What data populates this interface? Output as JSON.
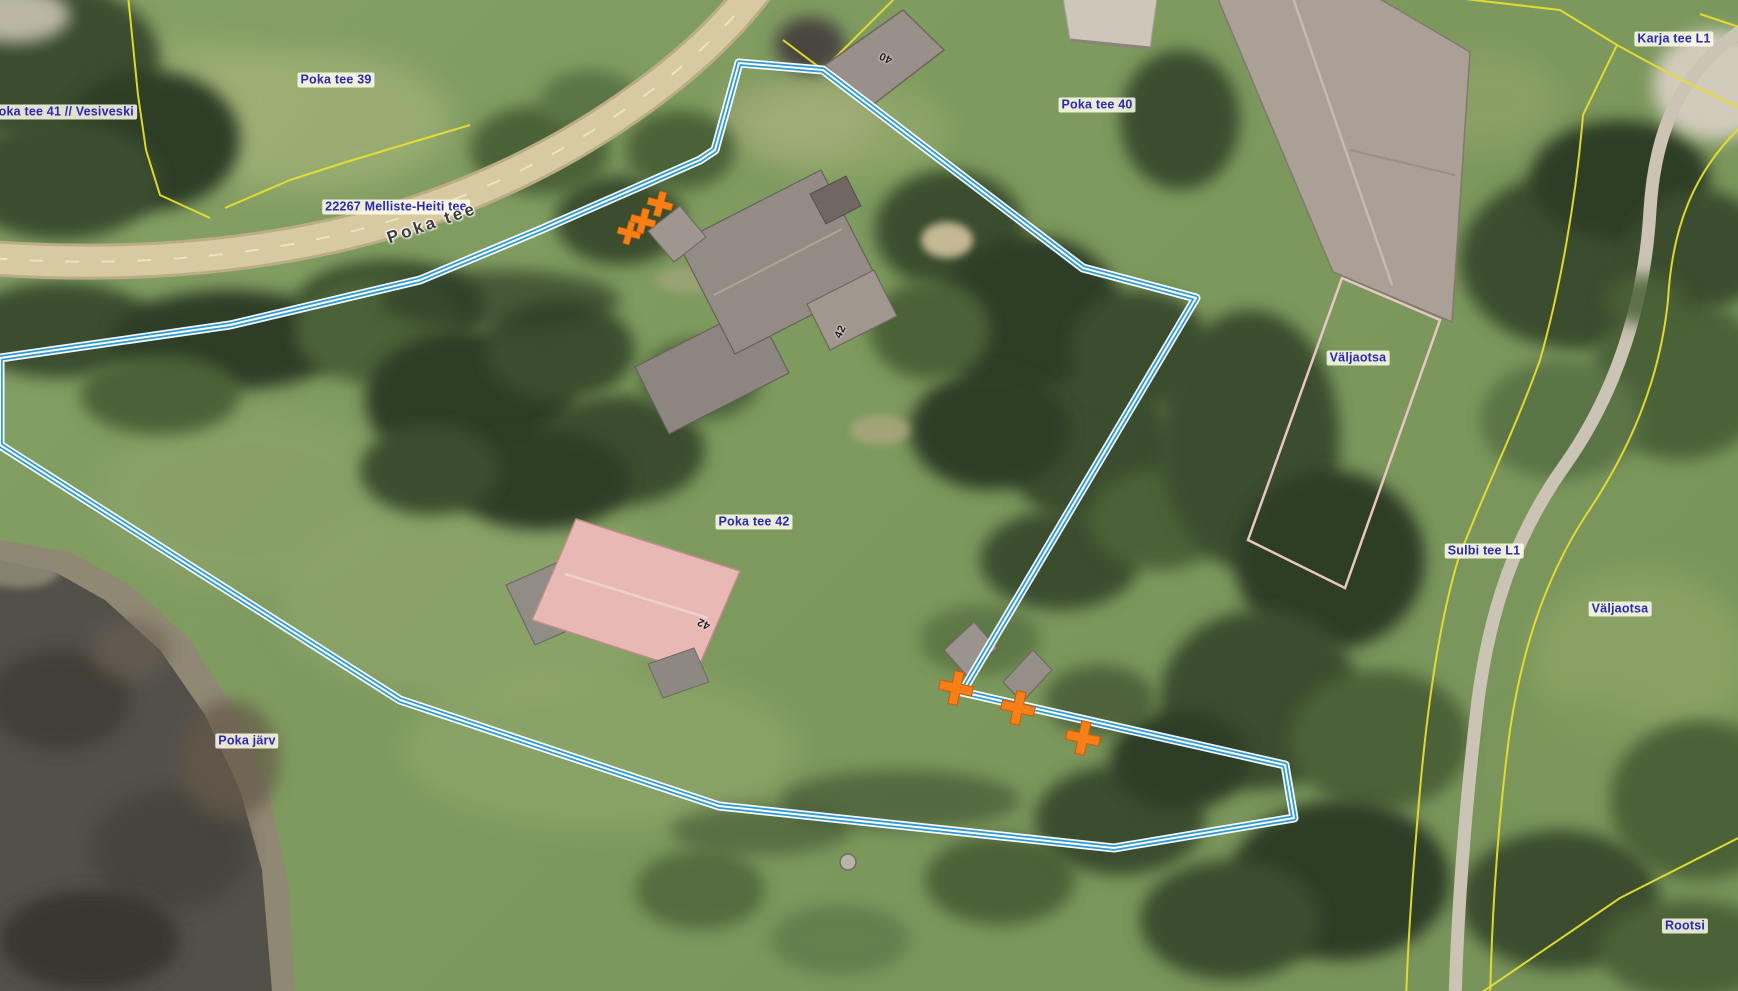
{
  "map": {
    "view": "aerial-cadastral-map",
    "labels": {
      "poka_tee_41": "Poka tee 41 // Vesiveski",
      "poka_tee_39": "Poka tee 39",
      "road_ref": "22267 Melliste-Heiti tee",
      "road_name": "Poka tee",
      "poka_tee_40": "Poka tee 40",
      "karja_tee_l1": "Karja tee L1",
      "valjaotsa_north": "Väljaotsa",
      "sulbi_tee_l1": "Sulbi tee L1",
      "valjaotsa_east": "Väljaotsa",
      "poka_tee_42": "Poka tee 42",
      "poka_jarv": "Poka järv",
      "rootsi": "Rootsi"
    },
    "building_numbers": {
      "b40": "40",
      "b42_main": "42",
      "b42_south": "42"
    },
    "colors": {
      "selected_parcel_outline": "#2d9ad6",
      "cadastral_boundary": "#e6df2e",
      "land_unit_boundary": "#e8c6c4",
      "boundary_marker": "#f87f17",
      "label_text": "#2a2ab4",
      "road_fill": "#d7caa0"
    }
  }
}
